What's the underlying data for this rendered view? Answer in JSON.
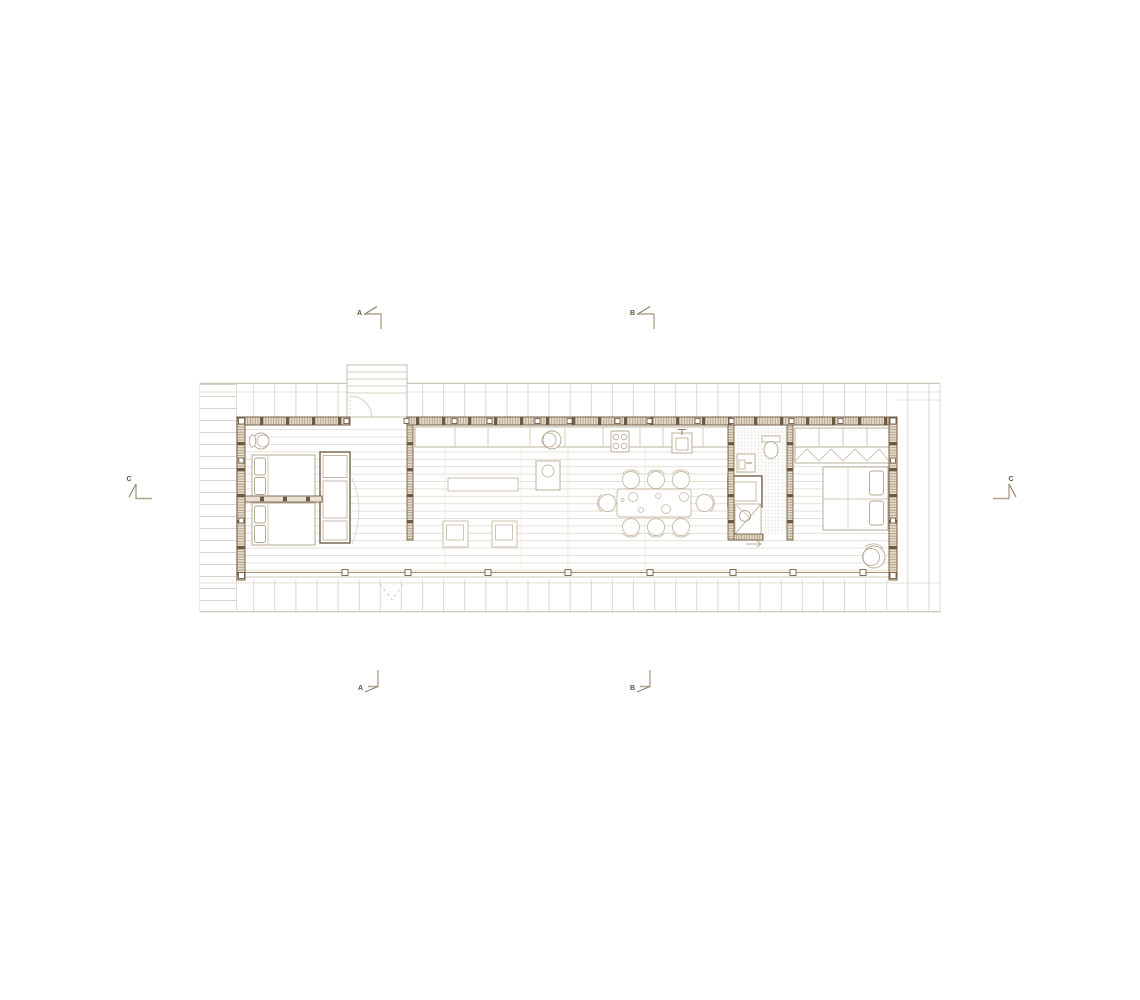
{
  "plan": {
    "section_markers": {
      "a_top": "A",
      "b_top": "B",
      "c_left": "C",
      "c_right": "C",
      "a_bottom": "A",
      "b_bottom": "B"
    },
    "palette": {
      "background": "#ffffff",
      "wall_dark": "#74614a",
      "wall_hatch": "#a3906f",
      "wall_fill": "#e3dbcb",
      "post_dark": "#6f5b41",
      "furniture_line": "#b6a88f",
      "furniture_light": "#c6b9a1",
      "floor_line": "#e6e1d7",
      "deck_line": "#d9d3c8",
      "marker_line": "#8d7e67",
      "marker_text": "#5f5140"
    }
  }
}
